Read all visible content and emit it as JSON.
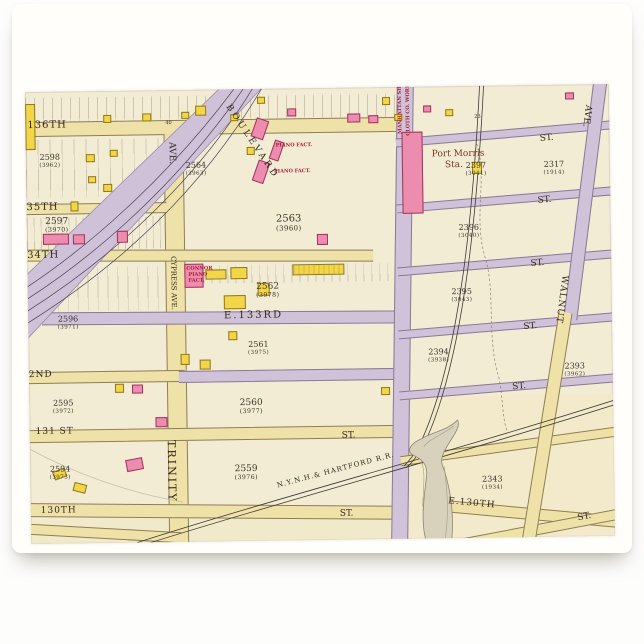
{
  "card": {
    "background": "#fffefb",
    "surface": "#fdfdfc"
  },
  "map": {
    "palette": {
      "paper": "#f2ecd5",
      "street_yellow": "#efe2a9",
      "street_purple": "#d0c2d8",
      "building_pink": "#ec8cae",
      "building_yellow": "#f2d647",
      "label_ink": "#33291c",
      "factory_red": "#a82138",
      "station_brown": "#7a3424"
    },
    "tints": [
      {
        "x": 370,
        "y": 310,
        "w": 214,
        "h": 142,
        "c": "#f2e9c3",
        "o": 0.55
      },
      {
        "x": 0,
        "y": 428,
        "w": 374,
        "h": 24,
        "c": "#f0e7bf",
        "o": 0.5
      }
    ],
    "stripes": [
      {
        "x": 0,
        "y": 6,
        "w": 370,
        "h": 24,
        "g": 9
      },
      {
        "x": 0,
        "y": 48,
        "w": 136,
        "h": 58,
        "g": 12
      },
      {
        "x": 0,
        "y": 126,
        "w": 148,
        "h": 32,
        "g": 7
      },
      {
        "x": 0,
        "y": 176,
        "w": 136,
        "h": 44,
        "g": 10
      },
      {
        "x": 152,
        "y": 176,
        "w": 214,
        "h": 18,
        "g": 8
      }
    ],
    "streets": [
      {
        "x": 0,
        "y": 30,
        "w": 374,
        "h": 15,
        "c": "y"
      },
      {
        "x": 138,
        "y": 44,
        "w": 20,
        "h": 408,
        "c": "y",
        "v": 1
      },
      {
        "x": 0,
        "y": 112,
        "w": 140,
        "h": 11,
        "c": "y"
      },
      {
        "x": 0,
        "y": 160,
        "w": 346,
        "h": 12,
        "c": "y",
        "r": 0.8
      },
      {
        "x": 14,
        "y": 222,
        "w": 356,
        "h": 13,
        "c": "p",
        "r": 0.5
      },
      {
        "x": 0,
        "y": 280,
        "w": 156,
        "h": 12,
        "c": "y"
      },
      {
        "x": 150,
        "y": 281,
        "w": 222,
        "h": 12,
        "c": "p"
      },
      {
        "x": 0,
        "y": 338,
        "w": 374,
        "h": 13,
        "c": "y"
      },
      {
        "x": 0,
        "y": 415,
        "w": 374,
        "h": 14,
        "c": "y",
        "r": 1.2
      },
      {
        "x": 0,
        "y": 437,
        "w": 150,
        "h": 11,
        "c": "y",
        "r": 4
      },
      {
        "x": 366,
        "y": 0,
        "w": 17,
        "h": 452,
        "c": "p",
        "v": 1,
        "r": 1.5
      },
      {
        "x": 370,
        "y": 44,
        "w": 216,
        "h": 9,
        "c": "p",
        "r": -4
      },
      {
        "x": 370,
        "y": 110,
        "w": 216,
        "h": 9,
        "c": "p",
        "r": -4
      },
      {
        "x": 370,
        "y": 173,
        "w": 216,
        "h": 9,
        "c": "p",
        "r": -4
      },
      {
        "x": 370,
        "y": 236,
        "w": 216,
        "h": 9,
        "c": "p",
        "r": -4
      },
      {
        "x": 370,
        "y": 297,
        "w": 216,
        "h": 9,
        "c": "p",
        "r": -4
      },
      {
        "x": 370,
        "y": 356,
        "w": 218,
        "h": 10,
        "c": "y",
        "r": -7
      },
      {
        "x": 392,
        "y": 422,
        "w": 200,
        "h": 12,
        "c": "y",
        "r": 6
      },
      {
        "x": 428,
        "y": 438,
        "w": 170,
        "h": 11,
        "c": "y",
        "r": -10
      },
      {
        "x": 552,
        "y": -6,
        "w": 14,
        "h": 242,
        "c": "p",
        "v": 1,
        "r": 8
      },
      {
        "x": 510,
        "y": 226,
        "w": 14,
        "h": 238,
        "c": "y",
        "v": 1,
        "r": 10
      }
    ],
    "buildings": [
      {
        "x": 78,
        "y": 24,
        "w": 8,
        "h": 8,
        "c": "y"
      },
      {
        "x": 117,
        "y": 23,
        "w": 9,
        "h": 8,
        "c": "y"
      },
      {
        "x": 156,
        "y": 22,
        "w": 8,
        "h": 7,
        "c": "y"
      },
      {
        "x": 170,
        "y": 16,
        "w": 11,
        "h": 10,
        "c": "y"
      },
      {
        "x": 205,
        "y": 25,
        "w": 8,
        "h": 7,
        "c": "y"
      },
      {
        "x": 232,
        "y": 8,
        "w": 8,
        "h": 7,
        "c": "y"
      },
      {
        "x": 262,
        "y": 20,
        "w": 9,
        "h": 8,
        "c": "p"
      },
      {
        "x": 322,
        "y": 26,
        "w": 13,
        "h": 9,
        "c": "p"
      },
      {
        "x": 343,
        "y": 28,
        "w": 10,
        "h": 8,
        "c": "p"
      },
      {
        "x": 357,
        "y": 10,
        "w": 8,
        "h": 8,
        "c": "y"
      },
      {
        "x": 369,
        "y": 27,
        "w": 8,
        "h": 7,
        "c": "y"
      },
      {
        "x": 398,
        "y": 19,
        "w": 8,
        "h": 7,
        "c": "p"
      },
      {
        "x": 420,
        "y": 23,
        "w": 8,
        "h": 7,
        "c": "y"
      },
      {
        "x": 540,
        "y": 8,
        "w": 9,
        "h": 7,
        "c": "p"
      },
      {
        "x": 0,
        "y": 12,
        "w": 10,
        "h": 46,
        "c": "y"
      },
      {
        "x": 60,
        "y": 63,
        "w": 9,
        "h": 8,
        "c": "y"
      },
      {
        "x": 84,
        "y": 59,
        "w": 8,
        "h": 7,
        "c": "y"
      },
      {
        "x": 62,
        "y": 85,
        "w": 8,
        "h": 7,
        "c": "y"
      },
      {
        "x": 77,
        "y": 93,
        "w": 9,
        "h": 8,
        "c": "y"
      },
      {
        "x": 44,
        "y": 110,
        "w": 8,
        "h": 10,
        "c": "y"
      },
      {
        "x": 228,
        "y": 30,
        "w": 13,
        "h": 20,
        "c": "p",
        "r": 20
      },
      {
        "x": 246,
        "y": 52,
        "w": 10,
        "h": 20,
        "c": "p",
        "r": 20
      },
      {
        "x": 229,
        "y": 72,
        "w": 12,
        "h": 22,
        "c": "p",
        "r": 20
      },
      {
        "x": 221,
        "y": 58,
        "w": 8,
        "h": 8,
        "c": "y"
      },
      {
        "x": 376,
        "y": 45,
        "w": 21,
        "h": 82,
        "c": "p"
      },
      {
        "x": 446,
        "y": 76,
        "w": 10,
        "h": 12,
        "c": "y"
      },
      {
        "x": 16,
        "y": 142,
        "w": 26,
        "h": 11,
        "c": "p"
      },
      {
        "x": 46,
        "y": 143,
        "w": 12,
        "h": 10,
        "c": "p"
      },
      {
        "x": 90,
        "y": 140,
        "w": 11,
        "h": 12,
        "c": "p"
      },
      {
        "x": 290,
        "y": 146,
        "w": 11,
        "h": 11,
        "c": "p"
      },
      {
        "x": 157,
        "y": 174,
        "w": 19,
        "h": 24,
        "c": "p"
      },
      {
        "x": 178,
        "y": 180,
        "w": 21,
        "h": 10,
        "c": "y"
      },
      {
        "x": 203,
        "y": 178,
        "w": 17,
        "h": 12,
        "c": "y"
      },
      {
        "x": 265,
        "y": 176,
        "w": 52,
        "h": 11,
        "c": "y",
        "st": 1
      },
      {
        "x": 196,
        "y": 206,
        "w": 22,
        "h": 14,
        "c": "y"
      },
      {
        "x": 230,
        "y": 194,
        "w": 12,
        "h": 13,
        "c": "y"
      },
      {
        "x": 152,
        "y": 264,
        "w": 9,
        "h": 11,
        "c": "y"
      },
      {
        "x": 171,
        "y": 270,
        "w": 11,
        "h": 10,
        "c": "y"
      },
      {
        "x": 200,
        "y": 242,
        "w": 9,
        "h": 9,
        "c": "y"
      },
      {
        "x": 352,
        "y": 300,
        "w": 9,
        "h": 8,
        "c": "y"
      },
      {
        "x": 86,
        "y": 293,
        "w": 9,
        "h": 9,
        "c": "y"
      },
      {
        "x": 103,
        "y": 294,
        "w": 11,
        "h": 9,
        "c": "p"
      },
      {
        "x": 126,
        "y": 327,
        "w": 12,
        "h": 10,
        "c": "p"
      },
      {
        "x": 96,
        "y": 368,
        "w": 17,
        "h": 12,
        "c": "p",
        "r": -10
      },
      {
        "x": 23,
        "y": 378,
        "w": 13,
        "h": 9,
        "c": "y",
        "r": -20
      },
      {
        "x": 43,
        "y": 392,
        "w": 13,
        "h": 9,
        "c": "y",
        "r": 15
      }
    ],
    "labels": [
      {
        "t": "136TH",
        "x": 2,
        "y": 29,
        "s": 10,
        "ls": 1
      },
      {
        "t": "40",
        "x": 140,
        "y": 31,
        "s": 5
      },
      {
        "t": "35TH",
        "x": 0,
        "y": 111,
        "s": 10,
        "ls": 1
      },
      {
        "t": "34TH",
        "x": 0,
        "y": 159,
        "s": 10,
        "ls": 1
      },
      {
        "t": "E.133RD",
        "x": 196,
        "y": 222,
        "s": 10,
        "ls": 2
      },
      {
        "t": "2ND",
        "x": 0,
        "y": 279,
        "s": 9,
        "ls": 1
      },
      {
        "t": "131 ST",
        "x": 6,
        "y": 336,
        "s": 9,
        "ls": 1
      },
      {
        "t": "ST.",
        "x": 312,
        "y": 344,
        "s": 9
      },
      {
        "t": "130TH",
        "x": 10,
        "y": 415,
        "s": 9,
        "ls": 1
      },
      {
        "t": "ST.",
        "x": 309,
        "y": 422,
        "s": 9
      },
      {
        "t": "ST.",
        "x": 514,
        "y": 50,
        "s": 9,
        "r": -4
      },
      {
        "t": "ST.",
        "x": 511,
        "y": 112,
        "s": 9,
        "r": -4
      },
      {
        "t": "ST.",
        "x": 503,
        "y": 175,
        "s": 9,
        "r": -4
      },
      {
        "t": "ST.",
        "x": 495,
        "y": 238,
        "s": 9,
        "r": -4
      },
      {
        "t": "ST.",
        "x": 483,
        "y": 298,
        "s": 9,
        "r": -4
      },
      {
        "t": "E.130TH",
        "x": 418,
        "y": 411,
        "s": 9,
        "r": 6,
        "ls": 1
      },
      {
        "t": "ST.",
        "x": 546,
        "y": 430,
        "s": 9,
        "r": -10
      },
      {
        "t": "Port Morris",
        "x": 406,
        "y": 64,
        "s": 9,
        "cls": "pm"
      },
      {
        "t": "Sta.",
        "x": 419,
        "y": 75,
        "s": 9,
        "cls": "pm"
      },
      {
        "t": "AVE.",
        "x": 141,
        "y": 52,
        "s": 9,
        "v": 1
      },
      {
        "t": "CYPRESS AVE.",
        "x": 142,
        "y": 166,
        "s": 7,
        "v": 1
      },
      {
        "t": "TRINITY",
        "x": 136,
        "y": 350,
        "s": 11,
        "v": 1,
        "ls": 2
      },
      {
        "t": "WALNUT",
        "x": 532,
        "y": 190,
        "s": 9,
        "v": 1,
        "ls": 1,
        "r": 8
      },
      {
        "t": "AVE.",
        "x": 558,
        "y": 20,
        "s": 9,
        "v": 1,
        "r": 8
      },
      {
        "t": "BOULEVARD",
        "x": 206,
        "y": 14,
        "s": 9,
        "r": 57,
        "ls": 3
      },
      {
        "t": "N.Y.N.H.& HARTFORD R.R.",
        "x": 246,
        "y": 394,
        "s": 7,
        "r": -14,
        "ls": 1
      },
      {
        "t": "MANHATTAN SHADE",
        "x": 378,
        "y": 47,
        "s": 5,
        "v": 1,
        "f": 1,
        "cls": "fac"
      },
      {
        "t": "CLOTH CO. WORKS",
        "x": 386,
        "y": 49,
        "s": 5,
        "v": 1,
        "f": 1,
        "cls": "fac"
      },
      {
        "t": "PIANO FACT.",
        "x": 250,
        "y": 55,
        "s": 5,
        "cls": "fac"
      },
      {
        "t": "PIANO FACT.",
        "x": 248,
        "y": 81,
        "s": 5,
        "cls": "fac"
      },
      {
        "t": "CONNOR",
        "x": 159,
        "y": 177,
        "s": 5,
        "cls": "fac"
      },
      {
        "t": "PIANO",
        "x": 161,
        "y": 183,
        "s": 5,
        "cls": "fac"
      },
      {
        "t": "FACT.",
        "x": 161,
        "y": 189,
        "s": 5,
        "cls": "fac"
      },
      {
        "t": "23",
        "x": 449,
        "y": 29,
        "s": 5
      }
    ],
    "blocks": [
      {
        "n": "2598",
        "o": "(3962)",
        "x": 24,
        "y": 62,
        "s": 8
      },
      {
        "n": "2564",
        "o": "(3963)",
        "x": 170,
        "y": 72,
        "s": 8
      },
      {
        "n": "2563",
        "o": "(3960)",
        "x": 262,
        "y": 126,
        "s": 10
      },
      {
        "n": "2597",
        "o": "(3970)",
        "x": 30,
        "y": 126,
        "s": 9
      },
      {
        "n": "2562",
        "o": "(3978)",
        "x": 240,
        "y": 194,
        "s": 9
      },
      {
        "n": "2596",
        "o": "(3971)",
        "x": 40,
        "y": 224,
        "s": 8
      },
      {
        "n": "2561",
        "o": "(3975)",
        "x": 230,
        "y": 252,
        "s": 8
      },
      {
        "n": "2595",
        "o": "(3972)",
        "x": 34,
        "y": 308,
        "s": 8
      },
      {
        "n": "2560",
        "o": "(3977)",
        "x": 222,
        "y": 310,
        "s": 9
      },
      {
        "n": "2594",
        "o": "(3973)",
        "x": 30,
        "y": 374,
        "s": 8
      },
      {
        "n": "2559",
        "o": "(3976)",
        "x": 216,
        "y": 376,
        "s": 9
      },
      {
        "n": "2397",
        "o": "(3041)",
        "x": 450,
        "y": 76,
        "s": 8
      },
      {
        "n": "2317",
        "o": "(1914)",
        "x": 528,
        "y": 76,
        "s": 8
      },
      {
        "n": "2396",
        "o": "(3040)",
        "x": 442,
        "y": 138,
        "s": 8
      },
      {
        "n": "2395",
        "o": "(3043)",
        "x": 434,
        "y": 202,
        "s": 8
      },
      {
        "n": "2394",
        "o": "(3938)",
        "x": 410,
        "y": 262,
        "s": 8
      },
      {
        "n": "2393",
        "o": "(3962)",
        "x": 546,
        "y": 278,
        "s": 8
      },
      {
        "n": "2343",
        "o": "(1934)",
        "x": 462,
        "y": 390,
        "s": 8
      }
    ]
  }
}
